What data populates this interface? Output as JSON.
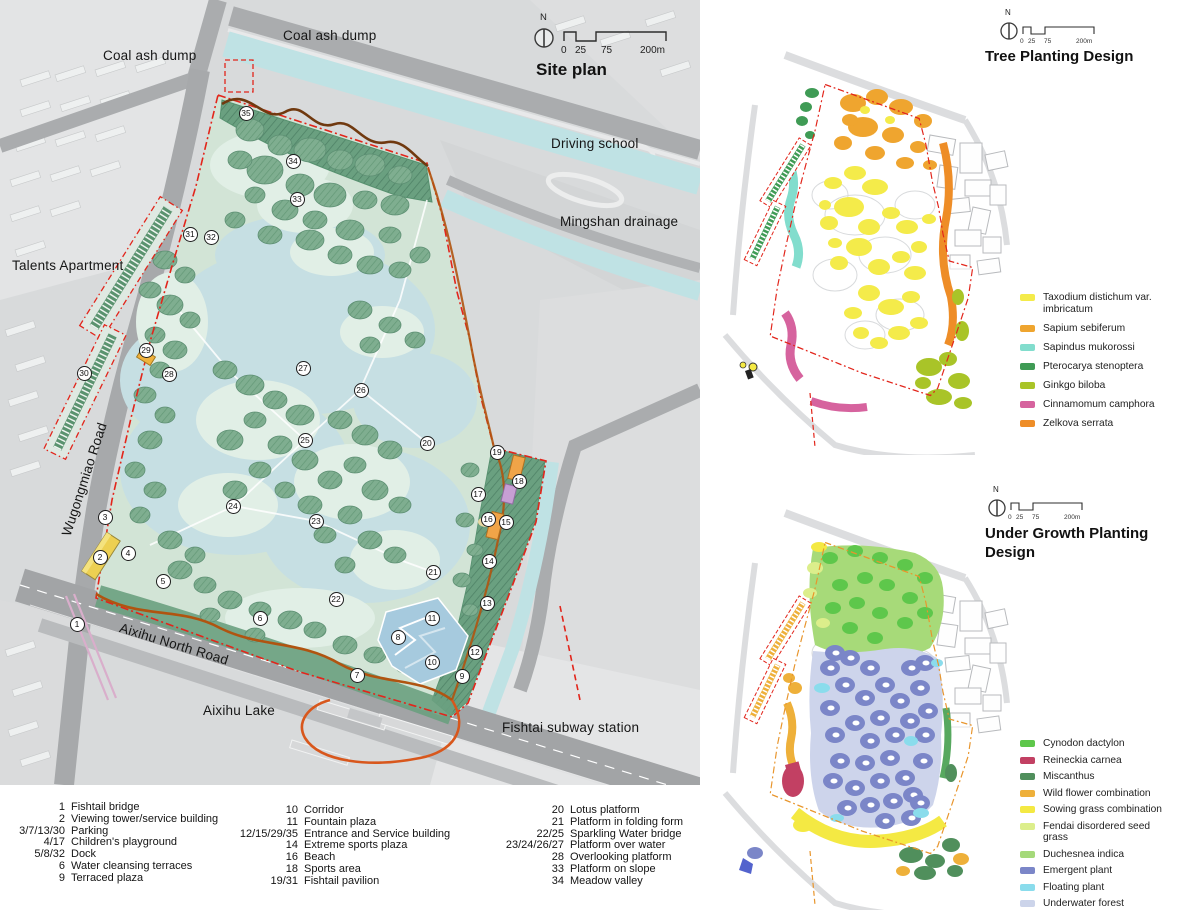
{
  "site_plan": {
    "title": "Site plan",
    "north_label": "N",
    "scale_ticks": [
      "0",
      "25",
      "75",
      "200m"
    ],
    "labels": [
      {
        "id": "coal-ash-dump-left",
        "text": "Coal ash dump",
        "x": 103,
        "y": 48,
        "rot": 0
      },
      {
        "id": "coal-ash-dump-top",
        "text": "Coal ash dump",
        "x": 283,
        "y": 28,
        "rot": 0
      },
      {
        "id": "driving-school",
        "text": "Driving school",
        "x": 551,
        "y": 136,
        "rot": 0
      },
      {
        "id": "mingshan-drainage",
        "text": "Mingshan drainage",
        "x": 560,
        "y": 214,
        "rot": 0
      },
      {
        "id": "talents-apartment",
        "text": "Talents Apartment",
        "x": 12,
        "y": 258,
        "rot": 0
      },
      {
        "id": "wugongmiao-road",
        "text": "Wugongmiao Road",
        "x": 66,
        "y": 528,
        "rot": -72
      },
      {
        "id": "aixihu-north-road",
        "text": "Aixihu North Road",
        "x": 120,
        "y": 620,
        "rot": 17
      },
      {
        "id": "aixihu-lake",
        "text": "Aixihu Lake",
        "x": 203,
        "y": 703,
        "rot": 0
      },
      {
        "id": "fishtai-subway-station",
        "text": "Fishtai subway station",
        "x": 502,
        "y": 720,
        "rot": 0
      }
    ],
    "markers": [
      {
        "n": "1",
        "x": 77,
        "y": 624
      },
      {
        "n": "2",
        "x": 100,
        "y": 557
      },
      {
        "n": "3",
        "x": 105,
        "y": 517
      },
      {
        "n": "4",
        "x": 128,
        "y": 553
      },
      {
        "n": "5",
        "x": 163,
        "y": 581
      },
      {
        "n": "6",
        "x": 260,
        "y": 618
      },
      {
        "n": "7",
        "x": 357,
        "y": 675
      },
      {
        "n": "8",
        "x": 398,
        "y": 637
      },
      {
        "n": "9",
        "x": 462,
        "y": 676
      },
      {
        "n": "10",
        "x": 432,
        "y": 662
      },
      {
        "n": "11",
        "x": 432,
        "y": 618
      },
      {
        "n": "12",
        "x": 475,
        "y": 652
      },
      {
        "n": "13",
        "x": 487,
        "y": 603
      },
      {
        "n": "14",
        "x": 489,
        "y": 561
      },
      {
        "n": "15",
        "x": 506,
        "y": 522
      },
      {
        "n": "16",
        "x": 488,
        "y": 519
      },
      {
        "n": "17",
        "x": 478,
        "y": 494
      },
      {
        "n": "18",
        "x": 519,
        "y": 481
      },
      {
        "n": "19",
        "x": 497,
        "y": 452
      },
      {
        "n": "20",
        "x": 427,
        "y": 443
      },
      {
        "n": "21",
        "x": 433,
        "y": 572
      },
      {
        "n": "22",
        "x": 336,
        "y": 599
      },
      {
        "n": "23",
        "x": 316,
        "y": 521
      },
      {
        "n": "24",
        "x": 233,
        "y": 506
      },
      {
        "n": "25",
        "x": 305,
        "y": 440
      },
      {
        "n": "26",
        "x": 361,
        "y": 390
      },
      {
        "n": "27",
        "x": 303,
        "y": 368
      },
      {
        "n": "28",
        "x": 169,
        "y": 374
      },
      {
        "n": "29",
        "x": 146,
        "y": 350
      },
      {
        "n": "30",
        "x": 84,
        "y": 373
      },
      {
        "n": "31",
        "x": 190,
        "y": 234
      },
      {
        "n": "32",
        "x": 211,
        "y": 237
      },
      {
        "n": "33",
        "x": 297,
        "y": 199
      },
      {
        "n": "34",
        "x": 293,
        "y": 161
      },
      {
        "n": "35",
        "x": 246,
        "y": 113
      }
    ]
  },
  "numbered_legend": {
    "columns": [
      {
        "items": [
          {
            "num": "1",
            "label": "Fishtail bridge"
          },
          {
            "num": "2",
            "label": "Viewing tower/service building"
          },
          {
            "num": "3/7/13/30",
            "label": "Parking"
          },
          {
            "num": "4/17",
            "label": "Children's playground"
          },
          {
            "num": "5/8/32",
            "label": "Dock"
          },
          {
            "num": "6",
            "label": "Water cleansing terraces"
          },
          {
            "num": "9",
            "label": "Terraced plaza"
          }
        ]
      },
      {
        "items": [
          {
            "num": "10",
            "label": "Corridor"
          },
          {
            "num": "11",
            "label": "Fountain plaza"
          },
          {
            "num": "12/15/29/35",
            "label": "Entrance and Service building"
          },
          {
            "num": "14",
            "label": "Extreme sports plaza"
          },
          {
            "num": "16",
            "label": "Beach"
          },
          {
            "num": "18",
            "label": "Sports area"
          },
          {
            "num": "19/31",
            "label": "Fishtail pavilion"
          }
        ]
      },
      {
        "items": [
          {
            "num": "20",
            "label": "Lotus platform"
          },
          {
            "num": "21",
            "label": "Platform in folding form"
          },
          {
            "num": "22/25",
            "label": "Sparkling Water bridge"
          },
          {
            "num": "23/24/26/27",
            "label": "Platform over water"
          },
          {
            "num": "28",
            "label": "Overlooking platform"
          },
          {
            "num": "33",
            "label": "Platform on slope"
          },
          {
            "num": "34",
            "label": "Meadow valley"
          }
        ]
      }
    ]
  },
  "tree_planting": {
    "title": "Tree Planting Design",
    "north_label": "N",
    "scale_ticks": [
      "0",
      "25",
      "75",
      "200m"
    ],
    "legend": [
      {
        "label": "Taxodium distichum var. imbricatum",
        "color": "#f4eb4a"
      },
      {
        "label": "Sapium sebiferum",
        "color": "#efa52f"
      },
      {
        "label": "Sapindus mukorossi",
        "color": "#82ddcd"
      },
      {
        "label": "Pterocarya stenoptera",
        "color": "#3f9b55"
      },
      {
        "label": "Ginkgo biloba",
        "color": "#a9c428"
      },
      {
        "label": "Cinnamomum camphora",
        "color": "#d6639e"
      },
      {
        "label": "Zelkova serrata",
        "color": "#ee8d27"
      }
    ]
  },
  "under_growth": {
    "title": "Under Growth Planting Design",
    "north_label": "N",
    "scale_ticks": [
      "0",
      "25",
      "75",
      "200m"
    ],
    "legend": [
      {
        "label": "Cynodon dactylon",
        "color": "#5ec74b"
      },
      {
        "label": "Reineckia carnea",
        "color": "#c24063"
      },
      {
        "label": "Miscanthus",
        "color": "#508f5c"
      },
      {
        "label": "Wild flower combination",
        "color": "#eeb03a"
      },
      {
        "label": "Sowing grass combination",
        "color": "#f4e943"
      },
      {
        "label": "Fendai disordered seed grass",
        "color": "#dcee8b"
      },
      {
        "label": "Duchesnea indica",
        "color": "#a5d97a"
      },
      {
        "label": "Emergent plant",
        "color": "#7b86c8"
      },
      {
        "label": "Floating plant",
        "color": "#8adcec"
      },
      {
        "label": "Underwater forest",
        "color": "#ccd4ea"
      }
    ]
  }
}
